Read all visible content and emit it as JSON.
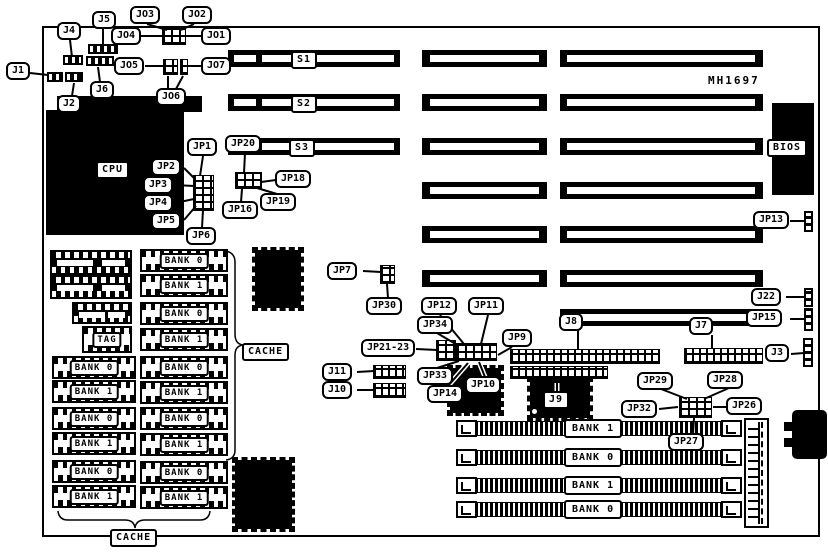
{
  "board": {
    "part_number": "MH1697"
  },
  "labels": {
    "j1": "J1",
    "j2": "J2",
    "j3": "J3",
    "j4": "J4",
    "j5": "J5",
    "j6": "J6",
    "j7": "J7",
    "j8": "J8",
    "j9": "J9",
    "j10": "J10",
    "j11": "J11",
    "j22": "J22",
    "jo1": "JO1",
    "jo2": "JO2",
    "jo3": "JO3",
    "jo4": "JO4",
    "jo5": "JO5",
    "jo6": "JO6",
    "jo7": "JO7",
    "s1": "S1",
    "s2": "S2",
    "s3": "S3",
    "jp1": "JP1",
    "jp2": "JP2",
    "jp3": "JP3",
    "jp4": "JP4",
    "jp5": "JP5",
    "jp6": "JP6",
    "jp7": "JP7",
    "jp9": "JP9",
    "jp10": "JP10",
    "jp11": "JP11",
    "jp12": "JP12",
    "jp13": "JP13",
    "jp14": "JP14",
    "jp15": "JP15",
    "jp16": "JP16",
    "jp18": "JP18",
    "jp19": "JP19",
    "jp20": "JP20",
    "jp21_23": "JP21-23",
    "jp26": "JP26",
    "jp27": "JP27",
    "jp28": "JP28",
    "jp29": "JP29",
    "jp30": "JP30",
    "jp32": "JP32",
    "jp33": "JP33",
    "jp34": "JP34",
    "cpu": "CPU",
    "bios": "BIOS"
  },
  "cache": {
    "left_column": [
      "TAG",
      "BANK 0",
      "BANK 1",
      "BANK 0",
      "BANK 1",
      "BANK 0",
      "BANK 1"
    ],
    "right_column": [
      "BANK 0",
      "BANK 1",
      "BANK 0",
      "BANK 1",
      "BANK 0",
      "BANK 1",
      "BANK 0",
      "BANK 1",
      "BANK 0",
      "BANK 1"
    ],
    "brace_label": "CACHE",
    "bottom_label": "CACHE"
  },
  "simm": {
    "banks": [
      "BANK 1",
      "BANK 0",
      "BANK 1",
      "BANK 0"
    ]
  },
  "colors": {
    "ink": "#000000",
    "board_bg": "#ffffff"
  }
}
